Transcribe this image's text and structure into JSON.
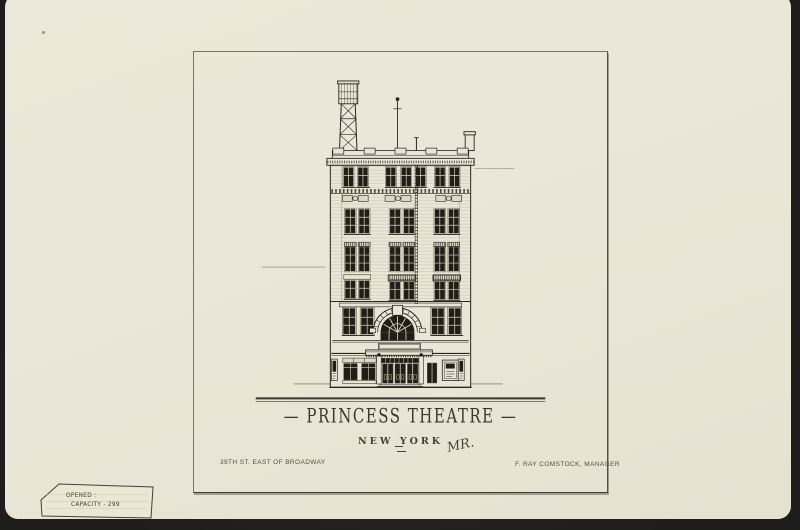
{
  "titles": {
    "main": "— PRINCESS THEATRE —",
    "city": "NEW YORK",
    "monogram": "MR."
  },
  "captions": {
    "address": "39TH ST.  EAST OF BROADWAY",
    "manager": "F. RAY COMSTOCK,  MANAGER"
  },
  "tag": {
    "line1": "OPENED :",
    "line2": "CAPACITY - 299"
  },
  "colors": {
    "background": "#232320",
    "card_paper": "#eae6d7",
    "ink": "#2a261e",
    "faint_ink": "#a89f88"
  }
}
